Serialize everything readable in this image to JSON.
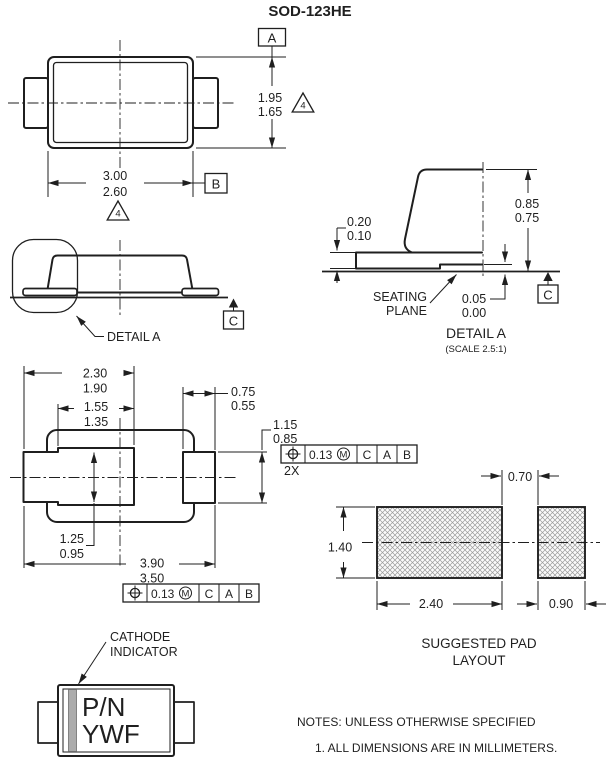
{
  "title": "SOD-123HE",
  "flags": {
    "note4": "4"
  },
  "datums": {
    "a": "A",
    "b": "B",
    "c": "C"
  },
  "top_view": {
    "dim_body_width": {
      "max": "3.00",
      "min": "2.60"
    },
    "dim_body_height": {
      "max": "1.95",
      "min": "1.65"
    }
  },
  "side_view": {
    "detail_callout": "DETAIL A"
  },
  "detail_a": {
    "title": "DETAIL A",
    "scale": "(SCALE 2.5:1)",
    "dim_lead_thickness": {
      "max": "0.20",
      "min": "0.10"
    },
    "dim_body_height": {
      "max": "0.85",
      "min": "0.75"
    },
    "dim_standoff": {
      "max": "0.05",
      "min": "0.00"
    },
    "seating_plane_line1": "SEATING",
    "seating_plane_line2": "PLANE"
  },
  "bottom_view": {
    "dim_cathode_terminal": {
      "max": "2.30",
      "min": "1.90"
    },
    "dim_inner_terminal": {
      "max": "1.55",
      "min": "1.35"
    },
    "dim_lead_width": {
      "max": "0.75",
      "min": "0.55"
    },
    "dim_anode_terminal": {
      "max": "1.15",
      "min": "0.85"
    },
    "dim_terminal_width": {
      "max": "1.25",
      "min": "0.95"
    },
    "dim_overall_length": {
      "max": "3.90",
      "min": "3.50"
    },
    "tolerance_count": "2X",
    "fcf": {
      "tolerance": "0.13",
      "modifier": "M",
      "datum1": "C",
      "datum2": "A",
      "datum3": "B"
    }
  },
  "pad_layout": {
    "title_line1": "SUGGESTED PAD",
    "title_line2": "LAYOUT",
    "dim_gap": "0.70",
    "dim_pad_height": "1.40",
    "dim_cathode_pad": "2.40",
    "dim_anode_pad": "0.90"
  },
  "marking_view": {
    "callout_line1": "CATHODE",
    "callout_line2": "INDICATOR",
    "marking_line1": "P/N",
    "marking_line2": "YWF"
  },
  "notes": {
    "header": "NOTES: UNLESS OTHERWISE SPECIFIED",
    "item1": "1.  ALL DIMENSIONS ARE IN MILLIMETERS."
  }
}
